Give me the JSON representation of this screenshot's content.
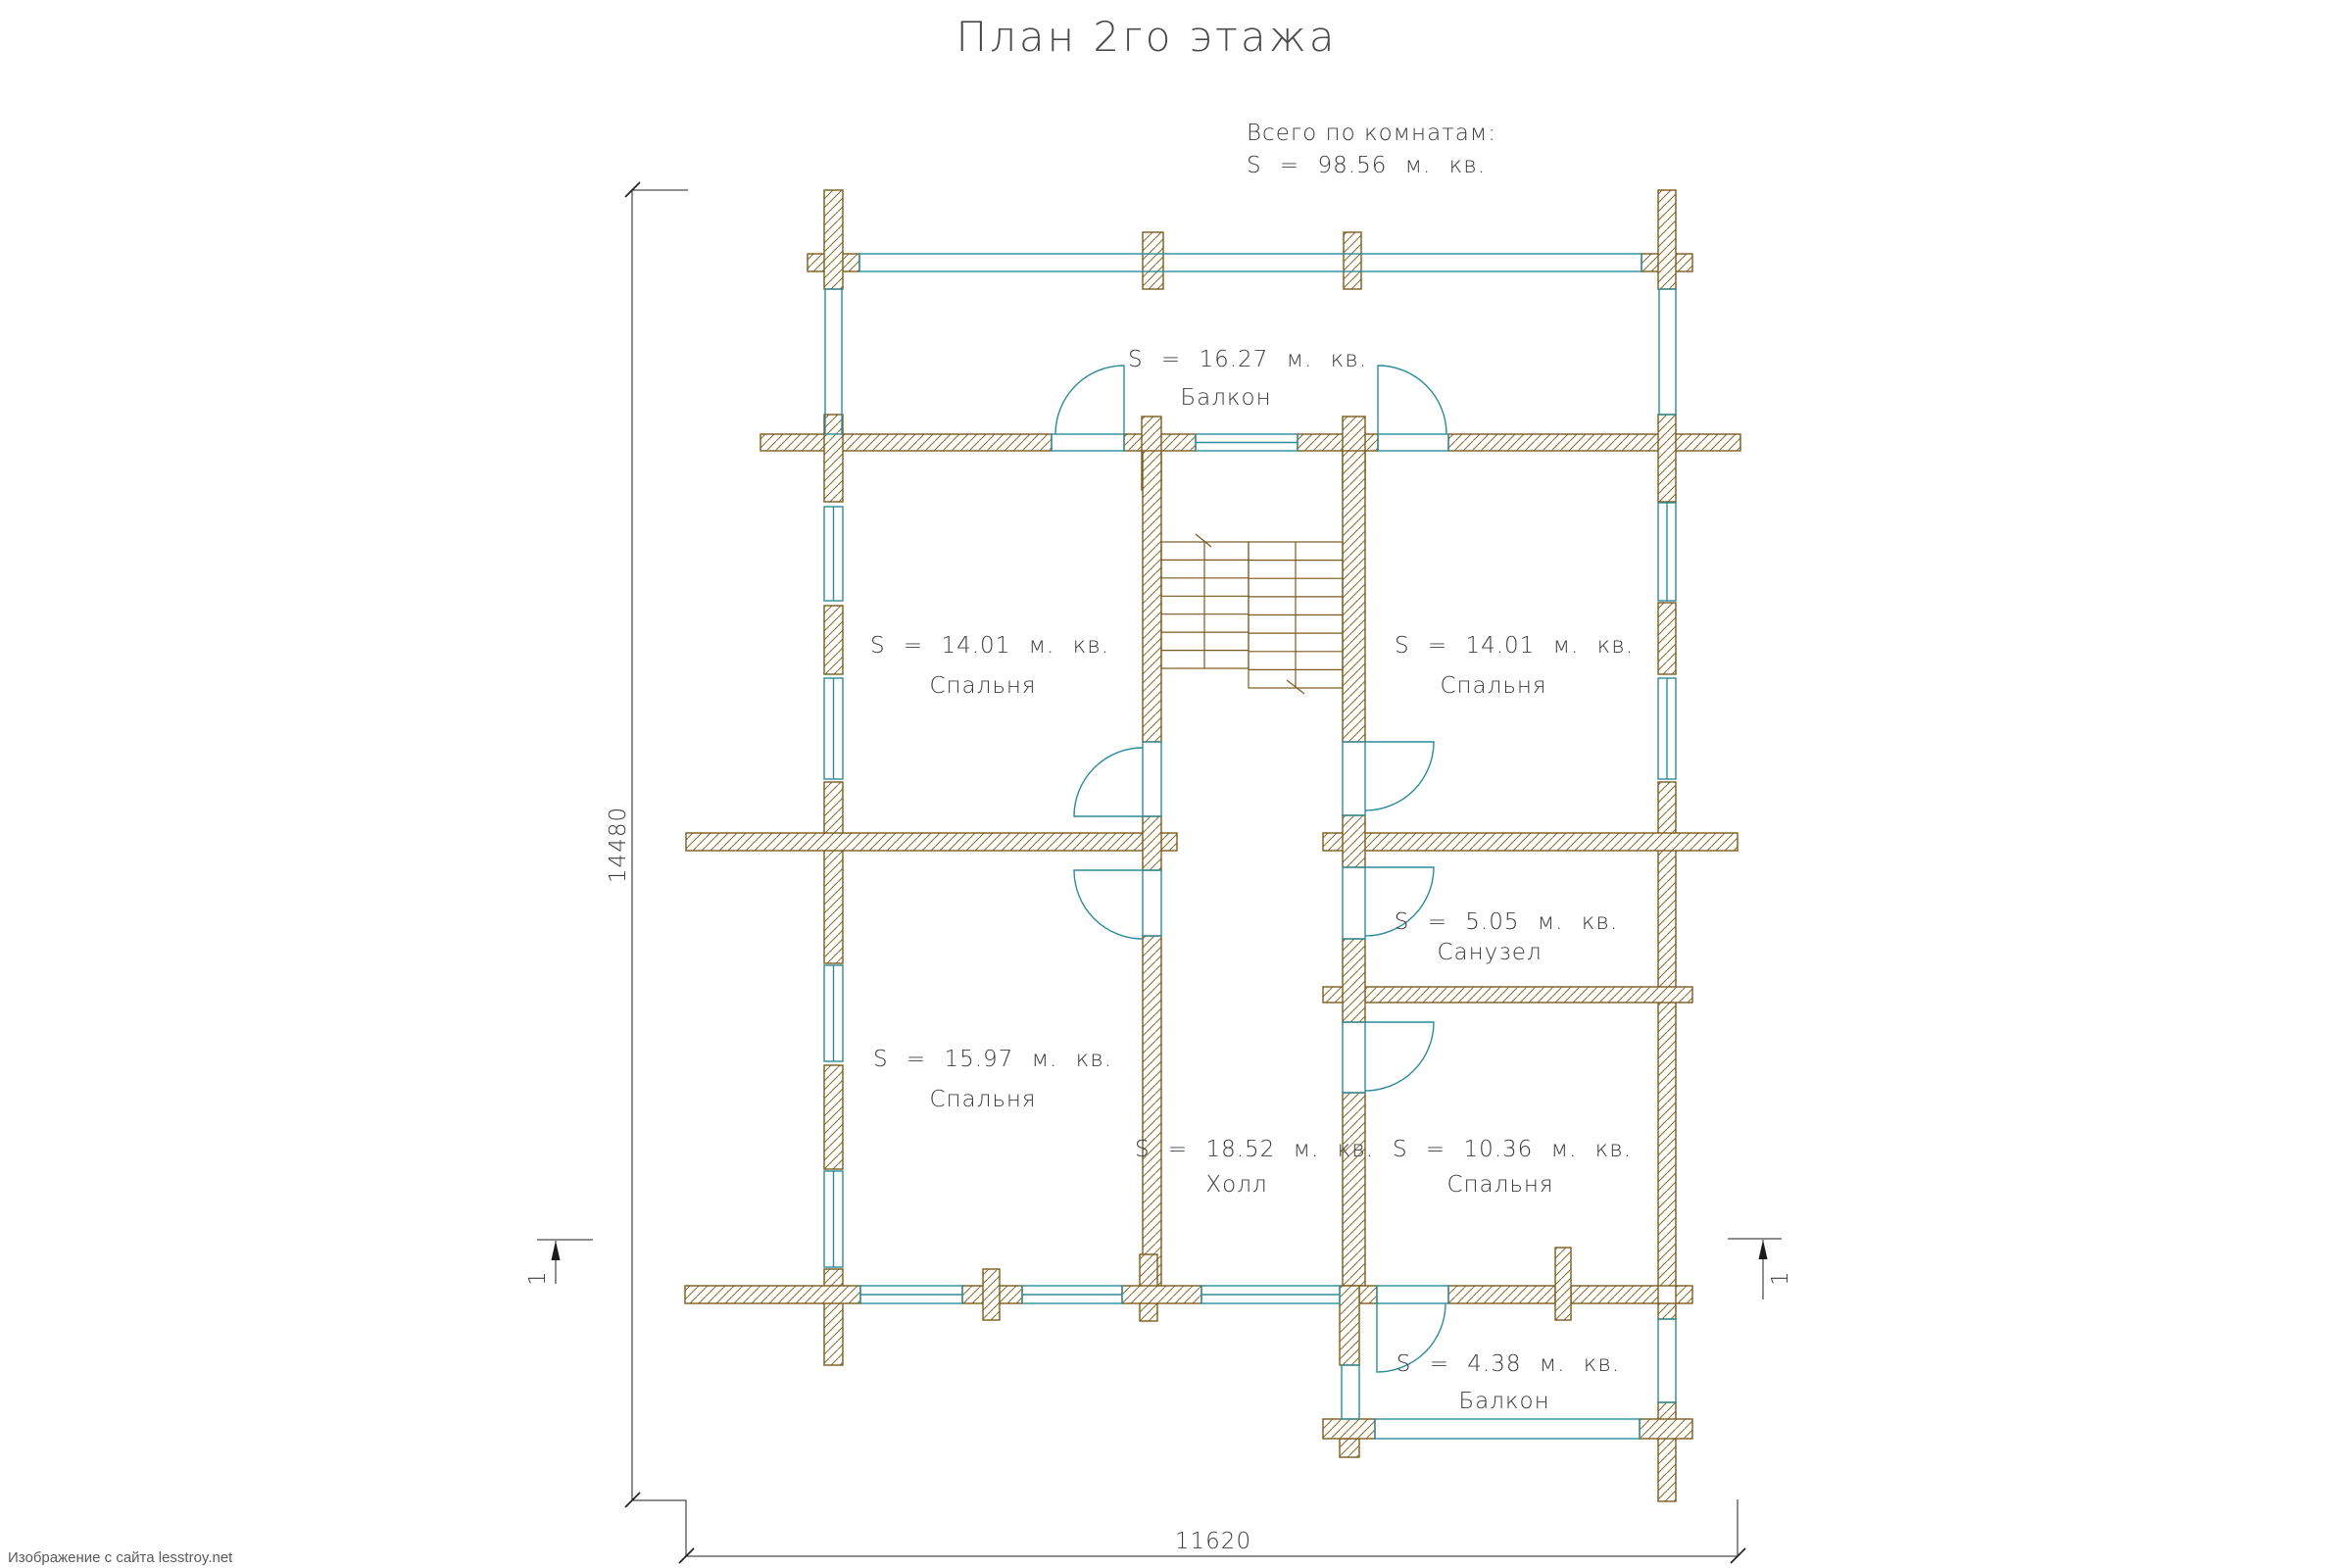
{
  "title": "План 2го этажа",
  "summary": {
    "heading": "Всего по комнатам:",
    "total": "S = 98.56 м. кв."
  },
  "rooms": [
    {
      "name": "Балкон",
      "area_label": "S = 16.27 м. кв."
    },
    {
      "name": "Спальня",
      "area_label": "S = 14.01 м. кв."
    },
    {
      "name": "Спальня",
      "area_label": "S = 14.01 м. кв."
    },
    {
      "name": "Санузел",
      "area_label": "S = 5.05 м. кв."
    },
    {
      "name": "Спальня",
      "area_label": "S = 15.97 м. кв."
    },
    {
      "name": "Холл",
      "area_label": "S = 18.52 м. кв."
    },
    {
      "name": "Спальня",
      "area_label": "S = 10.36 м. кв."
    },
    {
      "name": "Балкон",
      "area_label": "S = 4.38 м. кв."
    }
  ],
  "dimensions": {
    "height": "14480",
    "width": "11620"
  },
  "section_mark_label": "1",
  "watermark": "Изображение с сайта lesstroy.net",
  "colors": {
    "wall_outline": "#7a5a1e",
    "wall_hatch": "#8d6e2e",
    "glass": "#2e8b9b",
    "dimension": "#1c1c1c",
    "text": "#3c3c3c",
    "watermark": "#5a5a5a"
  }
}
